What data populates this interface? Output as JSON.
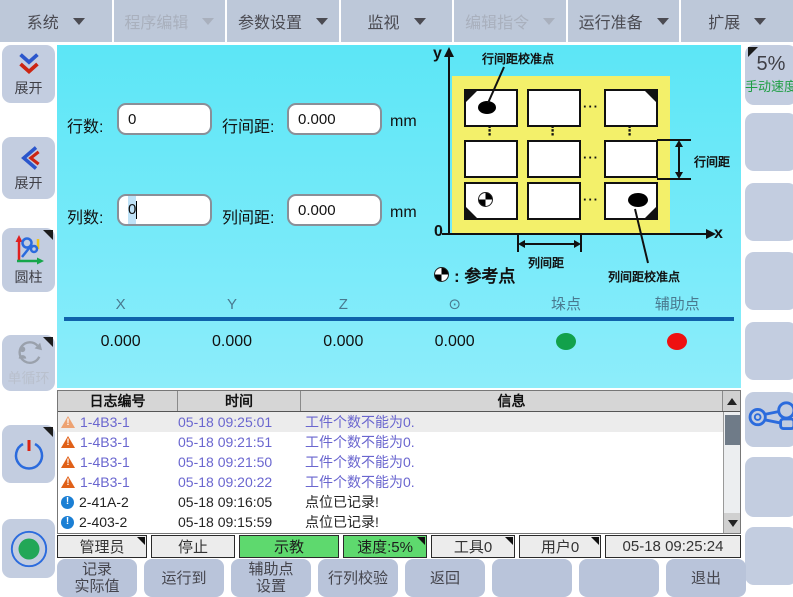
{
  "menu": {
    "items": [
      {
        "label": "系统",
        "enabled": true
      },
      {
        "label": "程序编辑",
        "enabled": false
      },
      {
        "label": "参数设置",
        "enabled": true
      },
      {
        "label": "监视",
        "enabled": true
      },
      {
        "label": "编辑指令",
        "enabled": false
      },
      {
        "label": "运行准备",
        "enabled": true
      },
      {
        "label": "扩展",
        "enabled": true
      }
    ]
  },
  "left_sidebar": {
    "expand_down_label": "展开",
    "expand_left_label": "展开",
    "cylinder_label": "圆柱",
    "single_cycle_label": "单循环"
  },
  "right_sidebar": {
    "speed_value": "5%",
    "speed_label": "手动速度"
  },
  "form": {
    "rows_label": "行数:",
    "rows_value": "0",
    "row_pitch_label": "行间距:",
    "row_pitch_value": "0.000",
    "cols_label": "列数:",
    "cols_value": "0",
    "col_pitch_label": "列间距:",
    "col_pitch_value": "0.000",
    "unit": "mm"
  },
  "diagram": {
    "y_axis": "y",
    "x_axis": "x",
    "origin": "0",
    "row_calib_label": "行间距校准点",
    "row_pitch_label": "行间距",
    "col_pitch_label": "列间距",
    "col_calib_label": "列间距校准点",
    "legend_label": ": 参考点",
    "dots_v": "⋮",
    "dots_h": "···"
  },
  "coords": {
    "headers": [
      "X",
      "Y",
      "Z",
      "⊙",
      "垛点",
      "辅助点"
    ],
    "values": [
      "0.000",
      "0.000",
      "0.000",
      "0.000"
    ],
    "stack_point_color": "#12a14b",
    "aux_point_color": "#ee1111"
  },
  "log": {
    "headers": [
      "日志编号",
      "时间",
      "信息"
    ],
    "rows": [
      {
        "type": "warn",
        "id": "1-4B3-1",
        "time": "05-18 09:25:01",
        "msg": "工件个数不能为0."
      },
      {
        "type": "warn",
        "id": "1-4B3-1",
        "time": "05-18 09:21:51",
        "msg": "工件个数不能为0."
      },
      {
        "type": "warn",
        "id": "1-4B3-1",
        "time": "05-18 09:21:50",
        "msg": "工件个数不能为0."
      },
      {
        "type": "warn",
        "id": "1-4B3-1",
        "time": "05-18 09:20:22",
        "msg": "工件个数不能为0."
      },
      {
        "type": "info",
        "id": "2-41A-2",
        "time": "05-18 09:16:05",
        "msg": "点位已记录!"
      },
      {
        "type": "info",
        "id": "2-403-2",
        "time": "05-18 09:15:59",
        "msg": "点位已记录!"
      },
      {
        "type": "info",
        "id": "2-41A-2",
        "time": "05-18 09:15:47",
        "msg": "点位已记录!"
      }
    ]
  },
  "status": {
    "user": "管理员",
    "run_state": "停止",
    "mode": "示教",
    "speed": "速度:5%",
    "tool": "工具0",
    "frame": "用户0",
    "datetime": "05-18 09:25:24"
  },
  "bottom": {
    "buttons": [
      "记录\n实际值",
      "运行到",
      "辅助点\n设置",
      "行列校验",
      "返回",
      "",
      "",
      "退出"
    ]
  }
}
